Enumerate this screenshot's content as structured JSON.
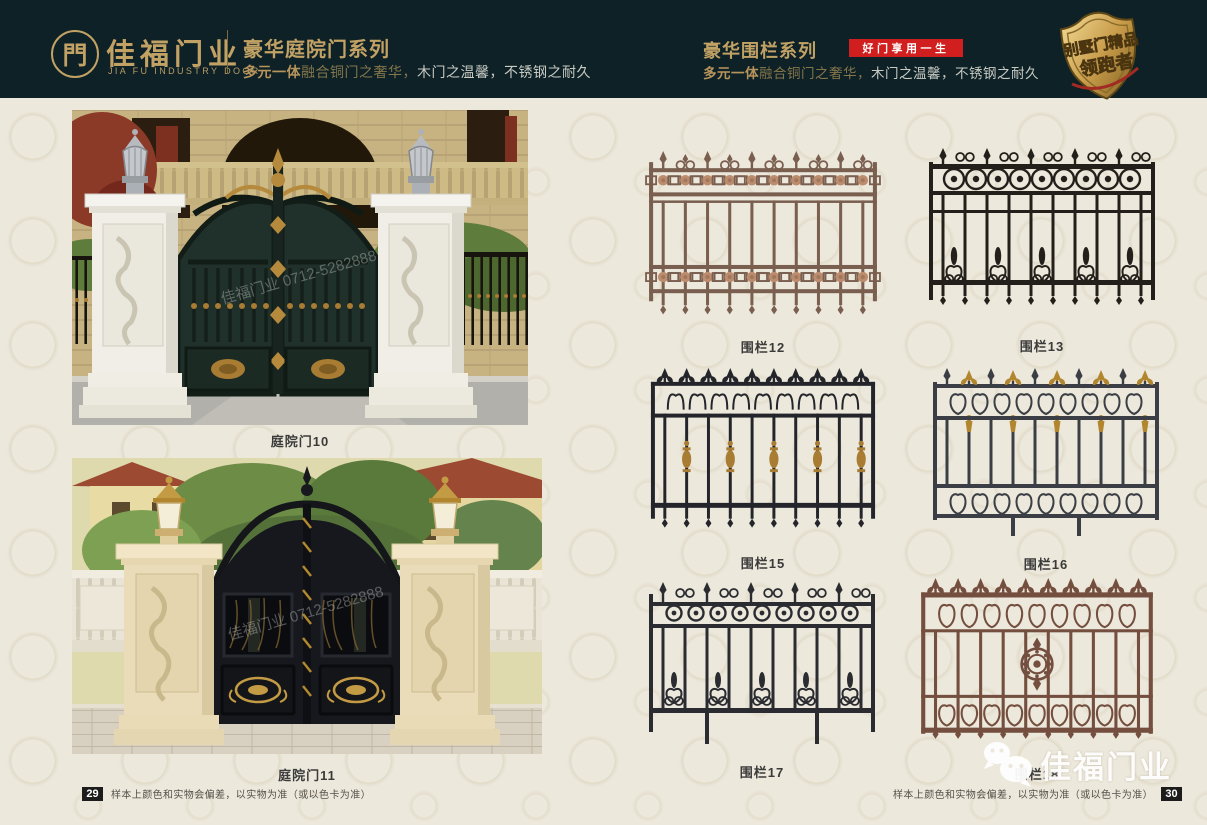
{
  "header": {
    "logo": {
      "glyph": "門",
      "brand_cn": "佳福门业",
      "brand_en": "JIA FU INDUSTRY DOOR"
    },
    "series_left": {
      "title": "豪华庭院门系列",
      "subtitle_em": "多元一体",
      "subtitle_mid": "融合铜门之奢华，",
      "subtitle_rest": "木门之温馨，不锈钢之耐久"
    },
    "series_right": {
      "title": "豪华围栏系列",
      "badge": "好门享用一生",
      "subtitle_em": "多元一体",
      "subtitle_mid": "融合铜门之奢华，",
      "subtitle_rest": "木门之温馨，不锈钢之耐久"
    },
    "emblem": {
      "line1": "别墅门精品",
      "line2": "领跑者"
    }
  },
  "products": {
    "doors": [
      {
        "label": "庭院门10"
      },
      {
        "label": "庭院门11"
      }
    ],
    "fences": [
      {
        "label": "围栏12",
        "style": "rosette",
        "color": "#7a5f50",
        "accent": "#bd8c6d"
      },
      {
        "label": "围栏13",
        "style": "circles",
        "color": "#231f1a",
        "accent": "#231f1a"
      },
      {
        "label": "围栏15",
        "style": "fleur-gold",
        "color": "#23252b",
        "accent": "#a87c33"
      },
      {
        "label": "围栏16",
        "style": "alt-gold",
        "color": "#3b3f45",
        "accent": "#b1862f"
      },
      {
        "label": "围栏17",
        "style": "circle-scroll",
        "color": "#2a2c31",
        "accent": "#2a2c31"
      },
      {
        "label": "围栏18",
        "style": "medallion",
        "color": "#744e3e",
        "accent": "#744e3e"
      }
    ]
  },
  "watermark": {
    "photo_text": "佳福门业 0712-5282888",
    "logo_text": "佳福门业"
  },
  "footer": {
    "left_page": "29",
    "right_page": "30",
    "note": "样本上颜色和实物会偏差，以实物为准（或以色卡为准）"
  },
  "colors": {
    "gold": "#c2a264",
    "header_bg": "#0d2127",
    "badge_red": "#d11e1e",
    "page_bg": "#ece8db"
  }
}
